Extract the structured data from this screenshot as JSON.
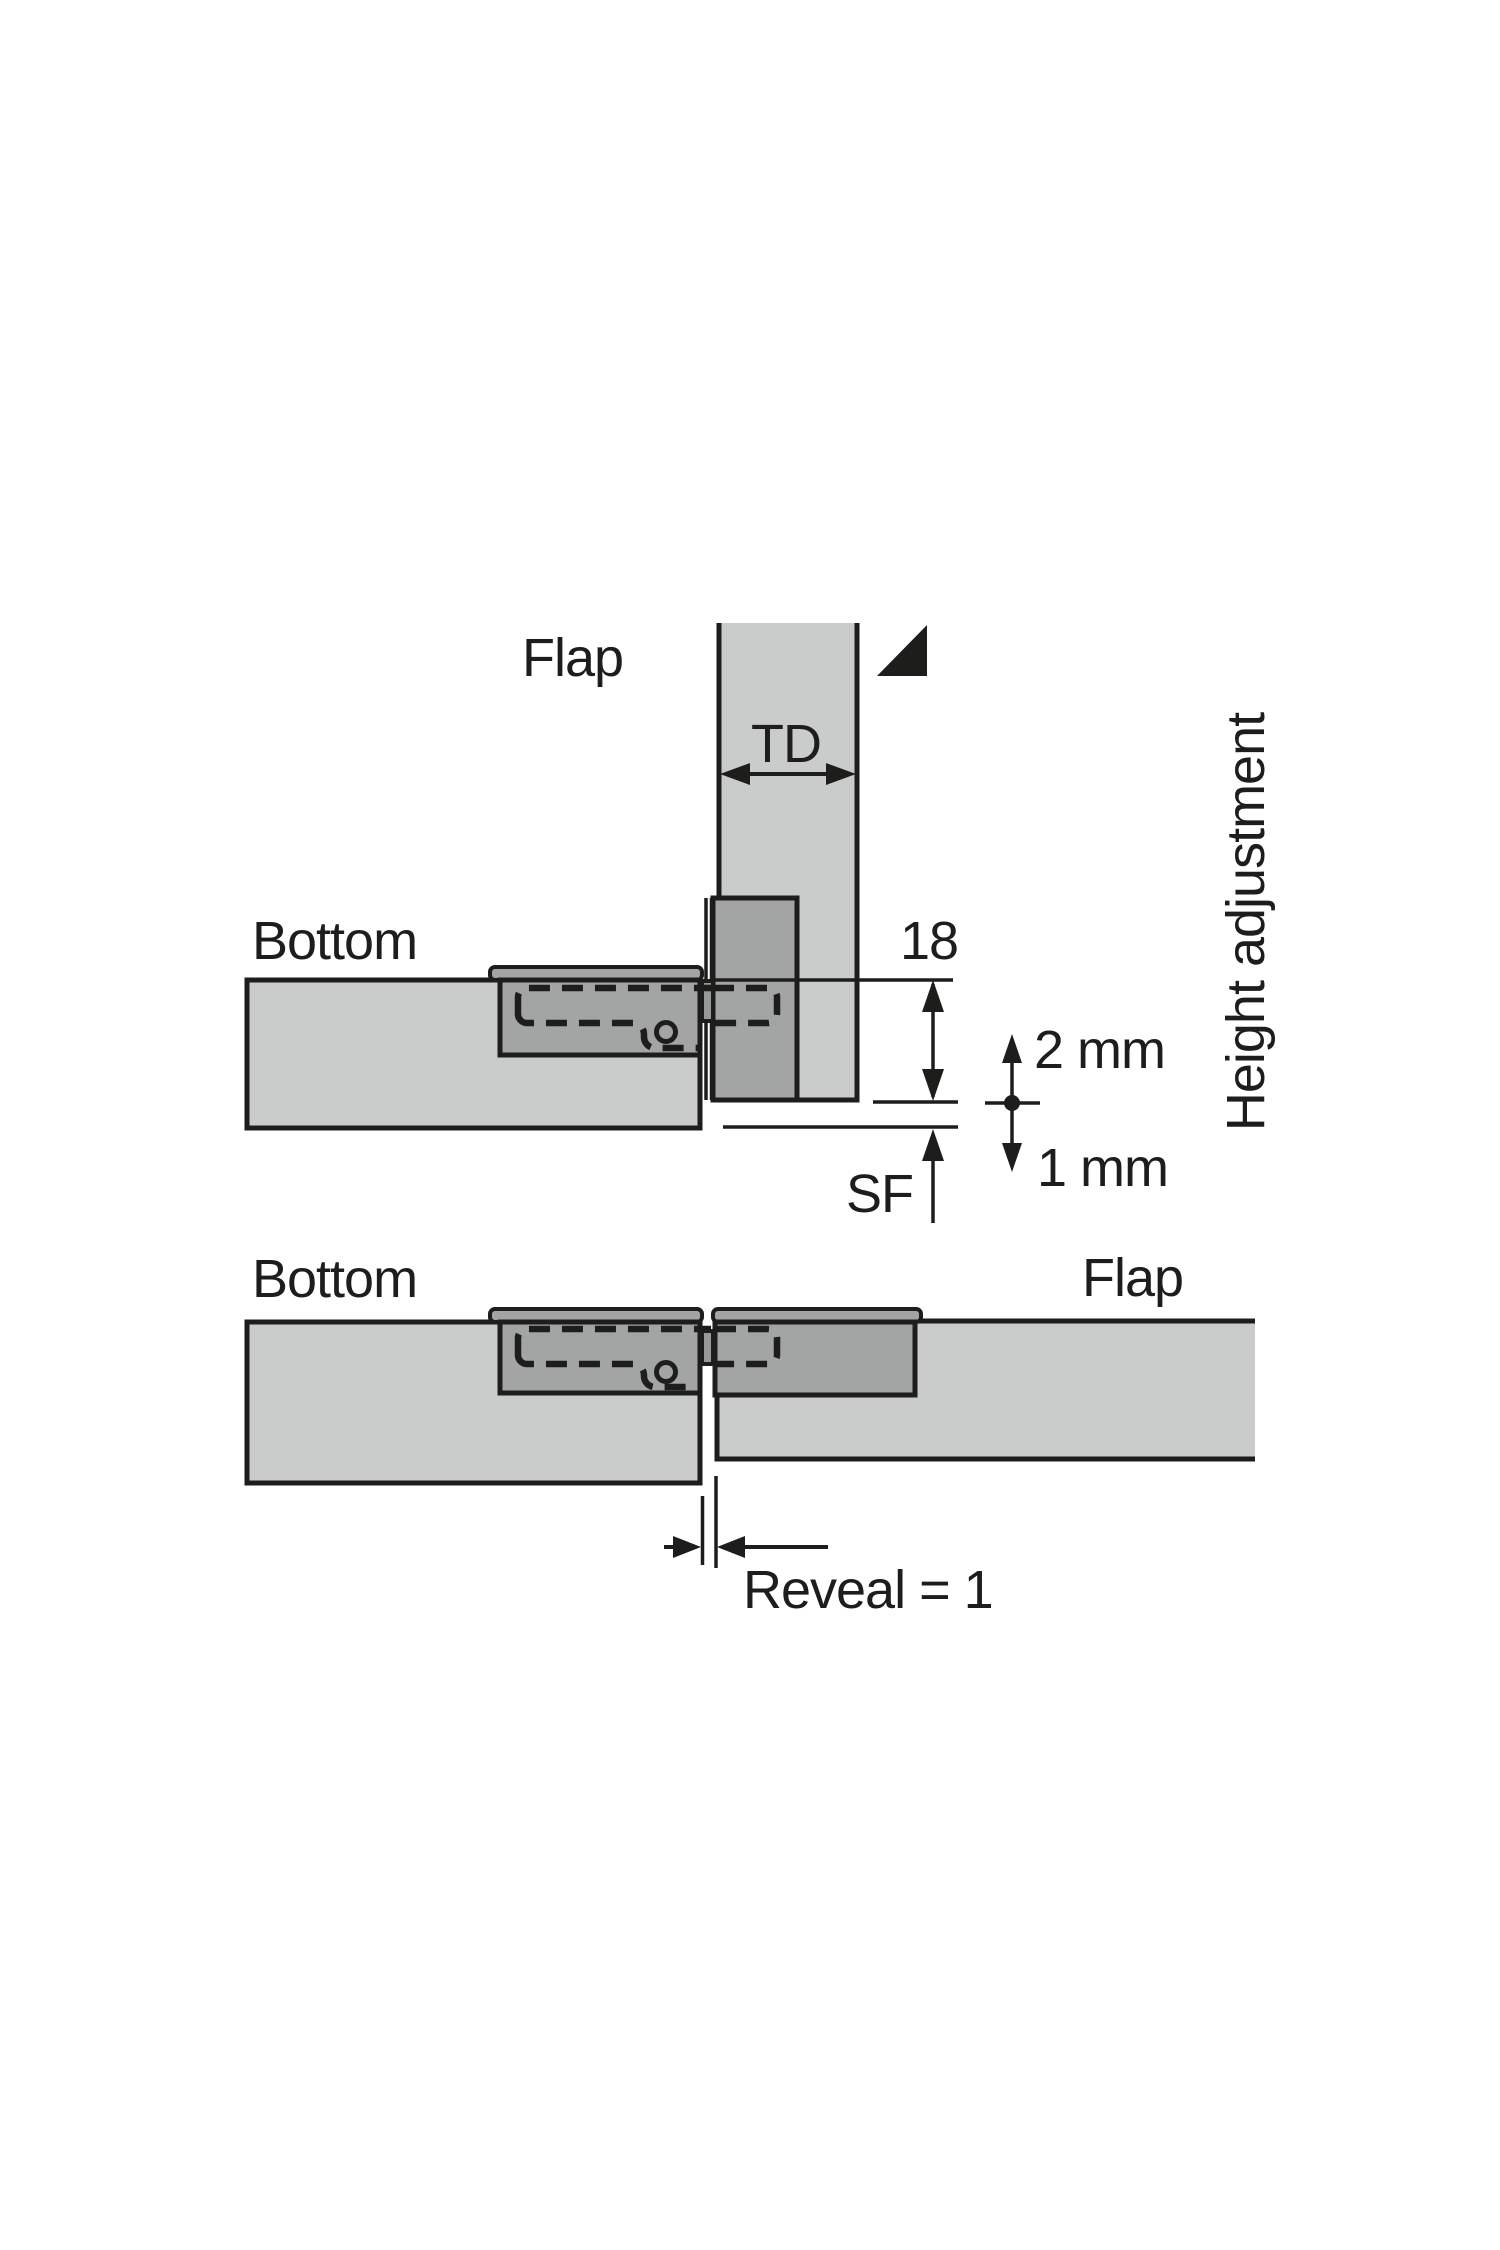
{
  "colors": {
    "background": "#ffffff",
    "panel_fill": "#cacccb",
    "hinge_fill": "#a3a5a4",
    "knuckle_fill": "#979998",
    "line": "#1d1d1b",
    "text": "#1d1d1b"
  },
  "top_diagram": {
    "flap_label": "Flap",
    "bottom_label": "Bottom",
    "thickness_label": "TD",
    "drilling_distance_label": "18",
    "side_clearance_label": "SF",
    "adjustment_up_label": "2 mm",
    "adjustment_down_label": "1 mm",
    "height_adjustment_label": "Height adjustment"
  },
  "bottom_diagram": {
    "bottom_label": "Bottom",
    "flap_label": "Flap",
    "reveal_label": "Reveal = 1"
  }
}
